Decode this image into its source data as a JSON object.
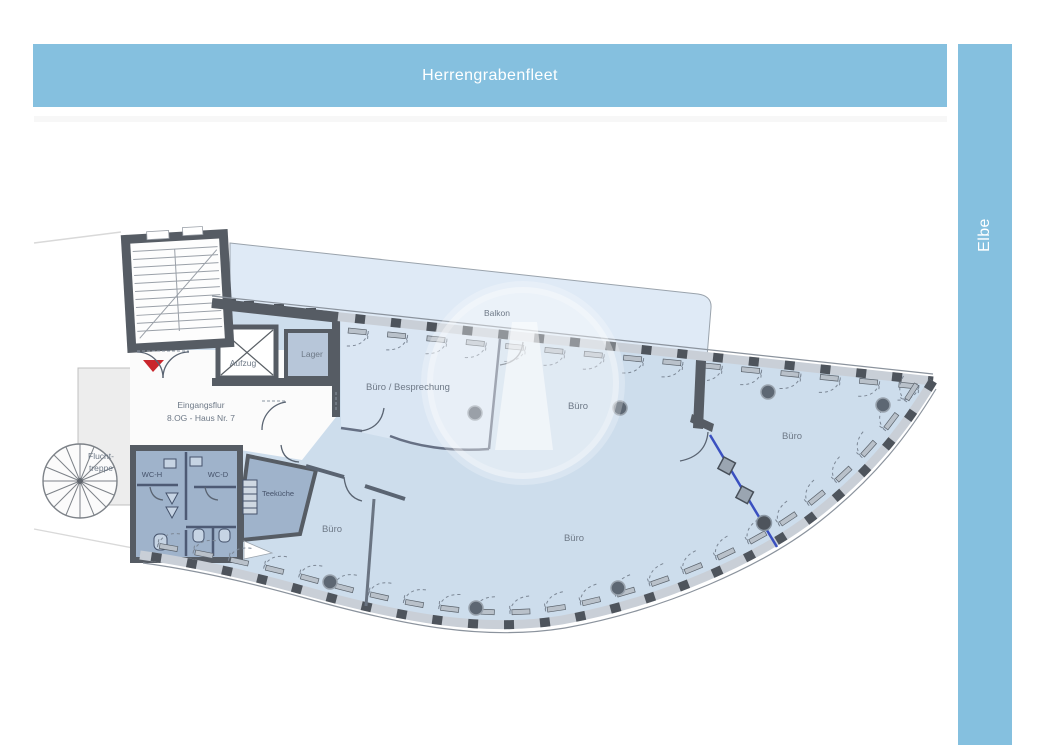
{
  "header": {
    "title": "Herrengrabenfleet"
  },
  "side": {
    "title": "Elbe"
  },
  "rooms": {
    "balkon": "Balkon",
    "besprechung": "Büro / Besprechung",
    "buero_top": "Büro",
    "buero_right": "Büro",
    "buero_main": "Büro",
    "buero_small": "Büro",
    "lager": "Lager",
    "aufzug": "Aufzug",
    "teekueche": "Teeküche",
    "wc_h": "WC-H",
    "wc_d": "WC-D",
    "eingang1": "Eingangsflur",
    "eingang2": "8.OG - Haus Nr. 7",
    "flucht1": "Flucht-",
    "flucht2": "treppe"
  },
  "colors": {
    "banner": "#85c0df",
    "bannerText": "#ffffff",
    "floor": "#cdddec",
    "floorLight": "#dae6f3",
    "balcony": "#dfeaf6",
    "service": "#9fb3cb",
    "storage": "#b7c6d9",
    "wall": "#565c64",
    "band": "#c9cfd7",
    "mullion": "#4e545c",
    "label": "#6e7987",
    "labelDark": "#46536b",
    "accentRed": "#c9262c",
    "partitionBlue": "#3a50c0",
    "escape": "#ededed"
  }
}
